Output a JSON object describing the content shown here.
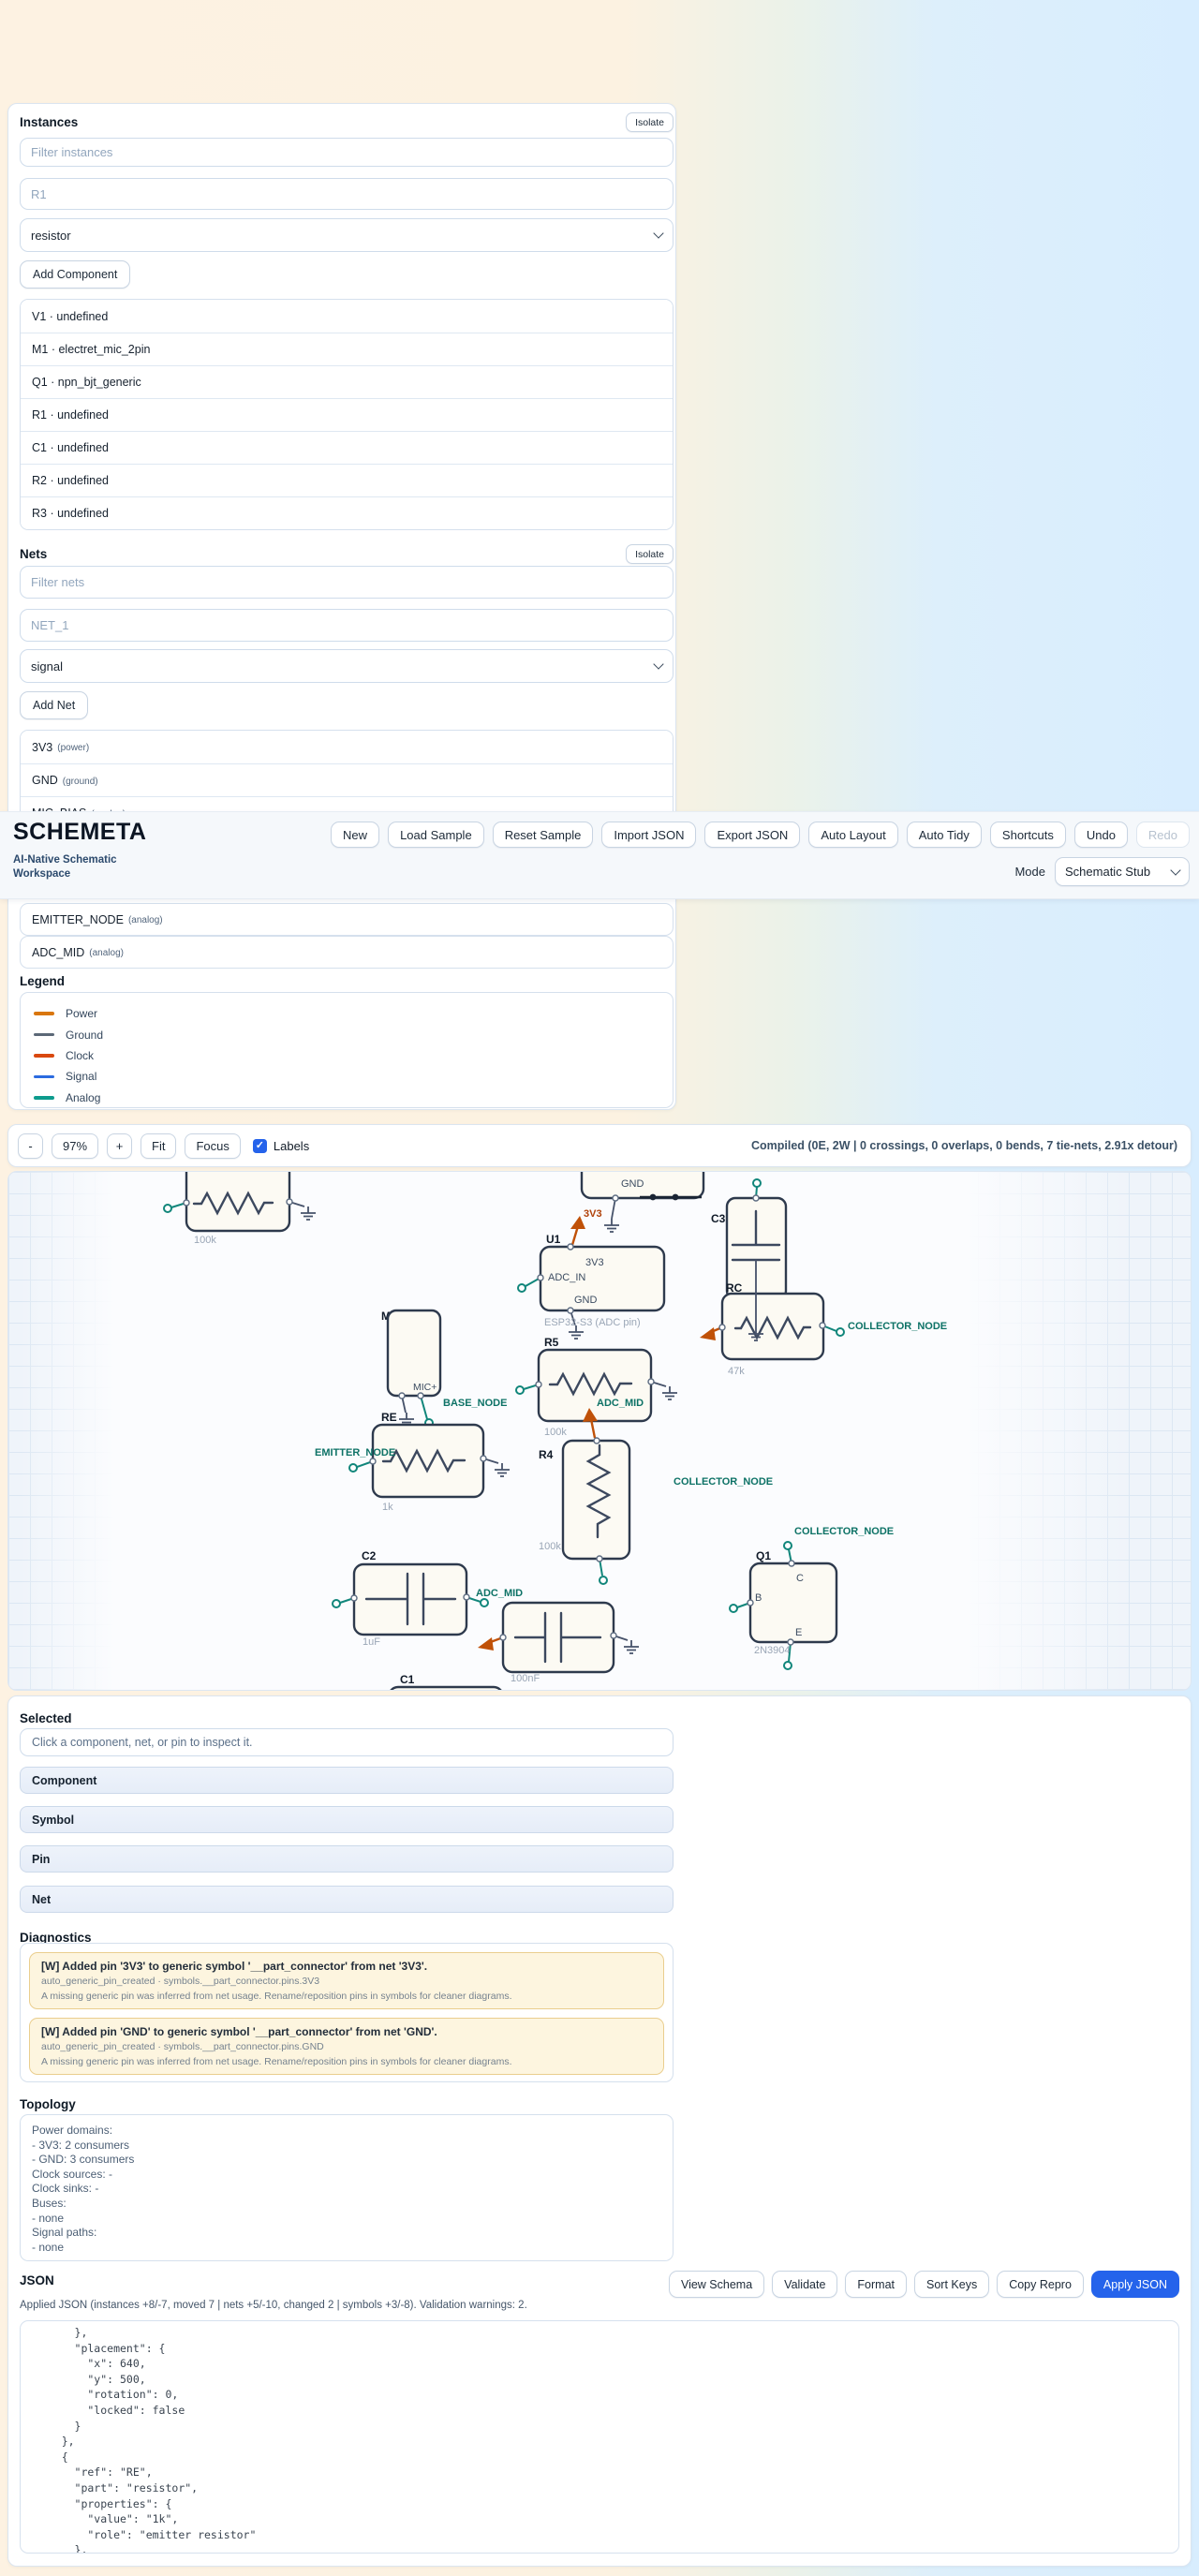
{
  "colors": {
    "accent": "#2563eb",
    "teal_net": "#11867b",
    "power_orange": "#c05108",
    "warning_bg": "#fdf5df"
  },
  "sidebar": {
    "instances": {
      "title": "Instances",
      "isolate": "Isolate",
      "filter_placeholder": "Filter instances",
      "name_placeholder": "R1",
      "type_value": "resistor",
      "add_button": "Add Component",
      "items": [
        "V1 · undefined",
        "M1 · electret_mic_2pin",
        "Q1 · npn_bjt_generic",
        "R1 · undefined",
        "C1 · undefined",
        "R2 · undefined",
        "R3 · undefined"
      ]
    },
    "nets": {
      "title": "Nets",
      "isolate": "Isolate",
      "filter_placeholder": "Filter nets",
      "name_placeholder": "NET_1",
      "type_value": "signal",
      "add_button": "Add Net",
      "items": [
        {
          "name": "3V3",
          "kind": "(power)"
        },
        {
          "name": "GND",
          "kind": "(ground)"
        },
        {
          "name": "MIC_BIAS",
          "kind": "(analog)"
        },
        {
          "name": "EMITTER_NODE",
          "kind": "(analog)"
        },
        {
          "name": "ADC_MID",
          "kind": "(analog)"
        }
      ]
    },
    "legend": {
      "title": "Legend",
      "items": [
        {
          "label": "Power",
          "color": "#d9760d"
        },
        {
          "label": "Ground",
          "color": "#5b6877"
        },
        {
          "label": "Clock",
          "color": "#d9480f"
        },
        {
          "label": "Signal",
          "color": "#2b6be0"
        },
        {
          "label": "Analog",
          "color": "#0d9b8d"
        }
      ]
    }
  },
  "header": {
    "app_name": "SCHEMETA",
    "tagline_line1": "AI-Native Schematic",
    "tagline_line2": "Workspace",
    "buttons": [
      "New",
      "Load Sample",
      "Reset Sample",
      "Import JSON",
      "Export JSON",
      "Auto Layout",
      "Auto Tidy",
      "Shortcuts",
      "Undo",
      "Redo"
    ],
    "mode_label": "Mode",
    "mode_value": "Schematic Stub"
  },
  "toolbar": {
    "zoom_out": "-",
    "zoom_level": "97%",
    "zoom_in": "+",
    "fit": "Fit",
    "focus": "Focus",
    "labels_checkbox": "Labels",
    "status": "Compiled (0E, 2W | 0 crossings, 0 overlaps, 0 bends, 7 tie-nets, 2.91x detour)"
  },
  "canvas": {
    "labels": {
      "r2_value": "100k",
      "pwr_gnd_pin": "GND",
      "pwr_3v3": "3V3",
      "u1_ref": "U1",
      "u1_pin_3v3": "3V3",
      "u1_pin_adc_in": "ADC_IN",
      "u1_pin_gnd": "GND",
      "u1_value": "ESP32-S3 (ADC pin)",
      "r5_ref": "R5",
      "r5_value": "100k",
      "net_base_node": "BASE_NODE",
      "net_adc_mid_1": "ADC_MID",
      "net_adc_mid_2": "ADC_MID",
      "m1_ref": "M1",
      "m1_pin_mic": "MIC+",
      "re_ref": "RE",
      "re_value": "1k",
      "net_emitter_node": "EMITTER_NODE",
      "r4_ref": "R4",
      "r4_value": "100k",
      "c2_ref": "C2",
      "c2_value": "1uF",
      "cin_value": "100nF",
      "c1_ref": "C1",
      "c3_ref": "C3",
      "rc_ref": "RC",
      "rc_value": "47k",
      "net_collector_node_1": "COLLECTOR_NODE",
      "net_collector_node_2": "COLLECTOR_NODE",
      "net_collector_node_3": "COLLECTOR_NODE",
      "q1_ref": "Q1",
      "q1_pin_c": "C",
      "q1_pin_b": "B",
      "q1_pin_e": "E",
      "q1_value": "2N3904"
    }
  },
  "selected": {
    "title": "Selected",
    "hint": "Click a component, net, or pin to inspect it.",
    "sections": [
      "Component",
      "Symbol",
      "Pin",
      "Net"
    ]
  },
  "diagnostics": {
    "title": "Diagnostics",
    "warnings": [
      {
        "title": "[W] Added pin '3V3' to generic symbol '__part_connector' from net '3V3'.",
        "meta": "auto_generic_pin_created · symbols.__part_connector.pins.3V3",
        "description": "A missing generic pin was inferred from net usage. Rename/reposition pins in symbols for cleaner diagrams."
      },
      {
        "title": "[W] Added pin 'GND' to generic symbol '__part_connector' from net 'GND'.",
        "meta": "auto_generic_pin_created · symbols.__part_connector.pins.GND",
        "description": "A missing generic pin was inferred from net usage. Rename/reposition pins in symbols for cleaner diagrams."
      }
    ]
  },
  "topology": {
    "title": "Topology",
    "lines": [
      "Power domains:",
      "- 3V3: 2 consumers",
      "- GND: 3 consumers",
      "Clock sources: -",
      "Clock sinks: -",
      "Buses:",
      "- none",
      "Signal paths:",
      "- none"
    ]
  },
  "json_panel": {
    "title": "JSON",
    "status": "Applied JSON (instances +8/-7, moved 7 | nets +5/-10, changed 2 | symbols +3/-8). Validation warnings: 2.",
    "buttons": [
      "View Schema",
      "Validate",
      "Format",
      "Sort Keys",
      "Copy Repro"
    ],
    "apply_button": "Apply JSON",
    "code_lines": [
      "      },",
      "      \"placement\": {",
      "        \"x\": 640,",
      "        \"y\": 500,",
      "        \"rotation\": 0,",
      "        \"locked\": false",
      "      }",
      "    },",
      "    {",
      "      \"ref\": \"RE\",",
      "      \"part\": \"resistor\",",
      "      \"properties\": {",
      "        \"value\": \"1k\",",
      "        \"role\": \"emitter resistor\"",
      "      },"
    ]
  }
}
